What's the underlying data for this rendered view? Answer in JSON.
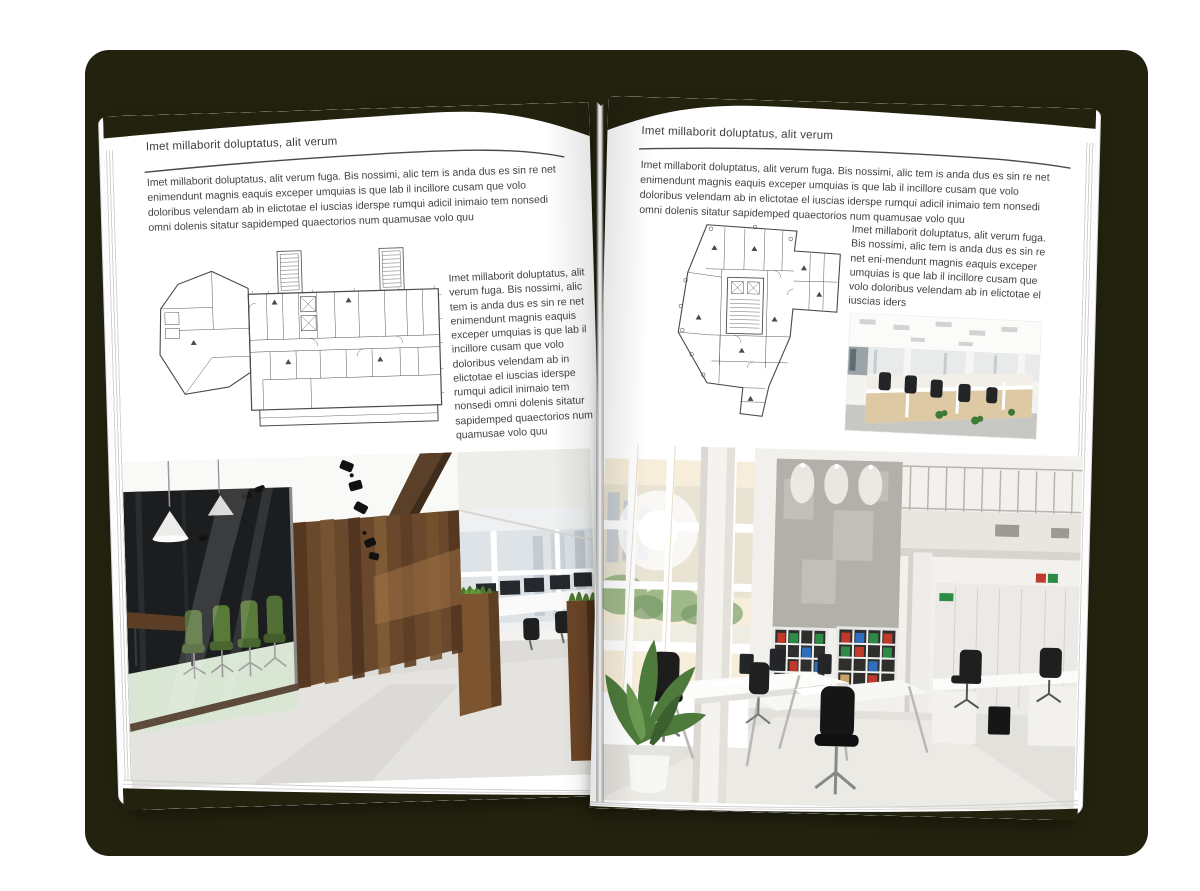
{
  "book": {
    "left_page": {
      "header": "Imet millaborit doluptatus, alit verum",
      "intro": "Imet millaborit doluptatus, alit verum fuga. Bis nossimi, alic tem is anda dus es sin re net enimendunt magnis eaquis exceper umquias is que lab il incillore cusam que volo doloribus velendam ab in elictotae el iuscias iderspe rumqui adicil inimaio tem nonsedi omni dolenis sitatur sapidemped quaectorios num quamusae volo quu",
      "side_text": "Imet millaborit doluptatus, alit verum fuga. Bis nossimi, alic tem is anda dus es sin re net enimendunt magnis eaquis exceper umquias is que lab il incillore cusam que volo doloribus velendam ab in elictotae el iuscias iderspe rumqui adicil inimaio tem nonsedi omni dolenis sitatur sapidemped quaectorios num quamusae volo quu",
      "floor_plan_name": "floor-plan-wide-office-building",
      "photo_name": "photo-office-dark-wood-glass-meeting-room"
    },
    "right_page": {
      "header": "Imet millaborit doluptatus, alit verum",
      "intro": "Imet millaborit doluptatus, alit verum fuga. Bis nossimi, alic tem is anda dus es sin re net enimendunt magnis eaquis exceper umquias is que lab il incillore cusam que volo doloribus velendam ab in elictotae el iuscias iderspe rumqui adicil inimaio tem nonsedi omni dolenis sitatur sapidemped quaectorios num quamusae volo quu",
      "side_text": "Imet millaborit doluptatus, alit verum fuga. Bis nossimi, alic tem is anda dus es sin re net eni-mendunt magnis eaquis exceper umquias is que lab il incillore cusam que volo doloribus velendam ab in elictotae el iuscias iders",
      "floor_plan_name": "floor-plan-tower-office-building",
      "photo_small_name": "photo-open-plan-workstations",
      "photo_large_name": "photo-white-loft-atrium-office"
    },
    "colors": {
      "backdrop": "#23220f",
      "page": "#ffffff",
      "text": "#434343",
      "meeting_room_chairs": "#5a7a3a",
      "wood_wall": "#6a482c",
      "binders": [
        "#c0392b",
        "#2e8b45",
        "#2f6fc0"
      ]
    }
  }
}
